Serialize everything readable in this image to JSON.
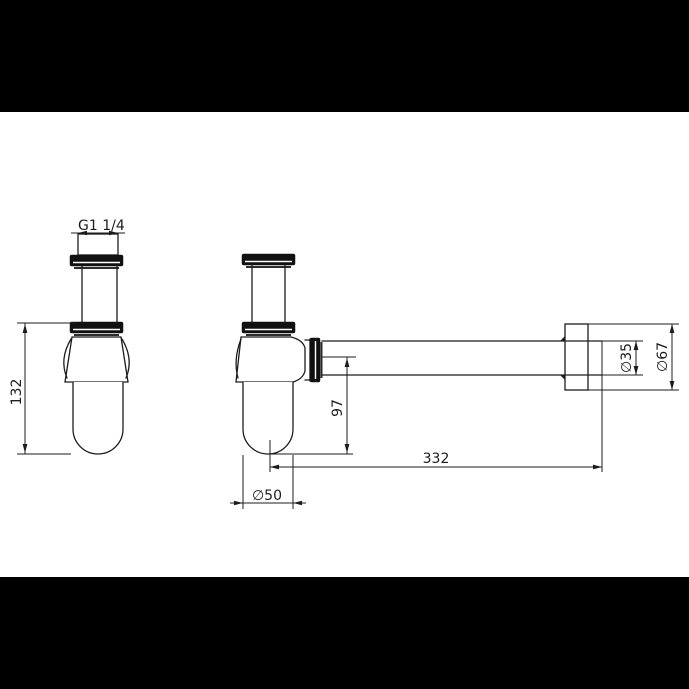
{
  "drawing": {
    "description": "Bottle trap siphon technical drawing, two orthographic views",
    "background": "#000000",
    "sheet_color": "#ffffff",
    "line_color": "#1c1c1c",
    "dims": {
      "thread_size": "G1 1/4",
      "body_height": "132",
      "outlet_drop": "97",
      "outlet_reach": "332",
      "pipe_diameter": "∅35",
      "flange_diameter": "∅67",
      "cup_diameter": "∅50"
    }
  }
}
